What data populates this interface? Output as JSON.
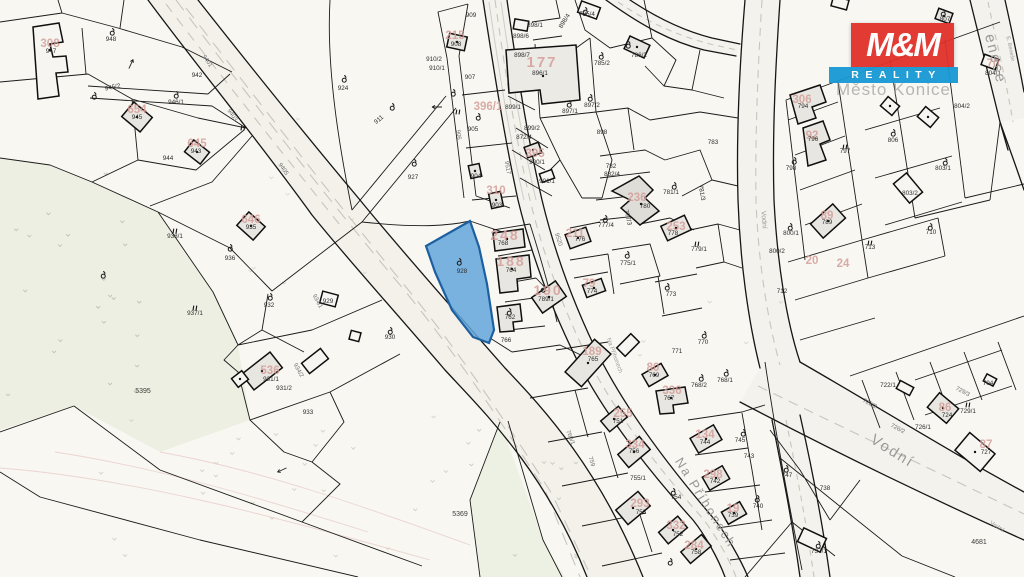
{
  "logo": {
    "mm": "M&M",
    "reality": "REALITY",
    "red": "#e0312a",
    "blue": "#1799d4"
  },
  "watermark": "Město Konice",
  "highlight": {
    "parcel_number": "928",
    "fill": "#63a6da",
    "stroke": "#1d5f9f"
  },
  "streets": [
    "Na Příhonech",
    "Vodní",
    "E. Beneše"
  ],
  "labels": {
    "parcels": [
      {
        "t": "948",
        "x": 111,
        "y": 41
      },
      {
        "t": "947",
        "x": 51,
        "y": 53
      },
      {
        "t": "946/2",
        "x": 113,
        "y": 89,
        "r": -12
      },
      {
        "t": "945",
        "x": 137,
        "y": 119
      },
      {
        "t": "946/1",
        "x": 176,
        "y": 104
      },
      {
        "t": "942",
        "x": 197,
        "y": 77
      },
      {
        "t": "944",
        "x": 168,
        "y": 160
      },
      {
        "t": "943",
        "x": 196,
        "y": 153
      },
      {
        "t": "924",
        "x": 343,
        "y": 90
      },
      {
        "t": "911",
        "x": 380,
        "y": 121,
        "r": -40
      },
      {
        "t": "927",
        "x": 413,
        "y": 179
      },
      {
        "t": "910/2",
        "x": 434,
        "y": 61
      },
      {
        "t": "910/1",
        "x": 437,
        "y": 70
      },
      {
        "t": "909",
        "x": 471,
        "y": 17
      },
      {
        "t": "908",
        "x": 456,
        "y": 46
      },
      {
        "t": "907",
        "x": 470,
        "y": 79
      },
      {
        "t": "905",
        "x": 473,
        "y": 131
      },
      {
        "t": "904",
        "x": 476,
        "y": 178
      },
      {
        "t": "903",
        "x": 497,
        "y": 207
      },
      {
        "t": "936",
        "x": 230,
        "y": 260
      },
      {
        "t": "935",
        "x": 251,
        "y": 229
      },
      {
        "t": "938/1",
        "x": 175,
        "y": 238
      },
      {
        "t": "937/1",
        "x": 195,
        "y": 315
      },
      {
        "t": "932",
        "x": 269,
        "y": 307
      },
      {
        "t": "929",
        "x": 328,
        "y": 303
      },
      {
        "t": "930",
        "x": 390,
        "y": 339
      },
      {
        "t": "931/1",
        "x": 271,
        "y": 381
      },
      {
        "t": "931/2",
        "x": 284,
        "y": 390
      },
      {
        "t": "933",
        "x": 308,
        "y": 414
      },
      {
        "t": "928",
        "x": 462,
        "y": 273
      },
      {
        "t": "898/1",
        "x": 535,
        "y": 27
      },
      {
        "t": "898/6",
        "x": 521,
        "y": 38
      },
      {
        "t": "898/7",
        "x": 522,
        "y": 57
      },
      {
        "t": "898/4",
        "x": 566,
        "y": 22,
        "r": -58
      },
      {
        "t": "896/1",
        "x": 540,
        "y": 75
      },
      {
        "t": "899/1",
        "x": 513,
        "y": 109
      },
      {
        "t": "899/2",
        "x": 532,
        "y": 130
      },
      {
        "t": "872/4",
        "x": 524,
        "y": 139
      },
      {
        "t": "900/1",
        "x": 537,
        "y": 164
      },
      {
        "t": "901/1",
        "x": 547,
        "y": 183
      },
      {
        "t": "785/4",
        "x": 587,
        "y": 16
      },
      {
        "t": "786/2",
        "x": 639,
        "y": 57
      },
      {
        "t": "785/2",
        "x": 602,
        "y": 65
      },
      {
        "t": "897/2",
        "x": 592,
        "y": 107
      },
      {
        "t": "897/1",
        "x": 570,
        "y": 113
      },
      {
        "t": "898",
        "x": 602,
        "y": 134
      },
      {
        "t": "783",
        "x": 713,
        "y": 144
      },
      {
        "t": "782",
        "x": 611,
        "y": 168
      },
      {
        "t": "882/4",
        "x": 612,
        "y": 176
      },
      {
        "t": "780",
        "x": 645,
        "y": 208
      },
      {
        "t": "781/1",
        "x": 671,
        "y": 194
      },
      {
        "t": "781/3",
        "x": 700,
        "y": 193,
        "r": 80
      },
      {
        "t": "777/4",
        "x": 606,
        "y": 227
      },
      {
        "t": "777/3",
        "x": 626,
        "y": 218,
        "r": 75
      },
      {
        "t": "778",
        "x": 673,
        "y": 235
      },
      {
        "t": "779/1",
        "x": 699,
        "y": 251
      },
      {
        "t": "776",
        "x": 580,
        "y": 241
      },
      {
        "t": "774",
        "x": 592,
        "y": 293
      },
      {
        "t": "775/1",
        "x": 628,
        "y": 265
      },
      {
        "t": "773",
        "x": 671,
        "y": 296
      },
      {
        "t": "768",
        "x": 503,
        "y": 245
      },
      {
        "t": "764",
        "x": 511,
        "y": 272
      },
      {
        "t": "789/1",
        "x": 546,
        "y": 301
      },
      {
        "t": "762",
        "x": 510,
        "y": 319
      },
      {
        "t": "766",
        "x": 506,
        "y": 342
      },
      {
        "t": "770",
        "x": 703,
        "y": 344
      },
      {
        "t": "771",
        "x": 677,
        "y": 353
      },
      {
        "t": "768/1",
        "x": 725,
        "y": 382
      },
      {
        "t": "768/2",
        "x": 699,
        "y": 387
      },
      {
        "t": "767",
        "x": 669,
        "y": 400
      },
      {
        "t": "769",
        "x": 654,
        "y": 377
      },
      {
        "t": "765",
        "x": 593,
        "y": 361
      },
      {
        "t": "751",
        "x": 618,
        "y": 423
      },
      {
        "t": "756",
        "x": 634,
        "y": 453
      },
      {
        "t": "755/1",
        "x": 638,
        "y": 480
      },
      {
        "t": "753",
        "x": 641,
        "y": 514
      },
      {
        "t": "754",
        "x": 676,
        "y": 499
      },
      {
        "t": "744",
        "x": 705,
        "y": 444
      },
      {
        "t": "745",
        "x": 740,
        "y": 442
      },
      {
        "t": "743",
        "x": 749,
        "y": 458
      },
      {
        "t": "742",
        "x": 715,
        "y": 483
      },
      {
        "t": "740",
        "x": 758,
        "y": 508
      },
      {
        "t": "739",
        "x": 733,
        "y": 517
      },
      {
        "t": "752",
        "x": 678,
        "y": 536
      },
      {
        "t": "758",
        "x": 696,
        "y": 554
      },
      {
        "t": "794",
        "x": 803,
        "y": 108
      },
      {
        "t": "796",
        "x": 813,
        "y": 141
      },
      {
        "t": "797",
        "x": 845,
        "y": 153
      },
      {
        "t": "798",
        "x": 791,
        "y": 170
      },
      {
        "t": "806",
        "x": 893,
        "y": 142
      },
      {
        "t": "803/1",
        "x": 943,
        "y": 170
      },
      {
        "t": "803/2",
        "x": 910,
        "y": 195
      },
      {
        "t": "800/1",
        "x": 791,
        "y": 235
      },
      {
        "t": "800/2",
        "x": 777,
        "y": 253
      },
      {
        "t": "789",
        "x": 827,
        "y": 224
      },
      {
        "t": "710",
        "x": 931,
        "y": 234
      },
      {
        "t": "713",
        "x": 870,
        "y": 249
      },
      {
        "t": "712",
        "x": 782,
        "y": 293
      },
      {
        "t": "807",
        "x": 945,
        "y": 21
      },
      {
        "t": "804/1",
        "x": 993,
        "y": 75
      },
      {
        "t": "804/2",
        "x": 962,
        "y": 108
      },
      {
        "t": "704",
        "x": 988,
        "y": 385
      },
      {
        "t": "722/1",
        "x": 888,
        "y": 387
      },
      {
        "t": "726/1",
        "x": 923,
        "y": 429
      },
      {
        "t": "724",
        "x": 947,
        "y": 417
      },
      {
        "t": "729/1",
        "x": 968,
        "y": 413
      },
      {
        "t": "727",
        "x": 986,
        "y": 454
      },
      {
        "t": "747",
        "x": 787,
        "y": 477
      },
      {
        "t": "738",
        "x": 825,
        "y": 490
      },
      {
        "t": "737/1",
        "x": 819,
        "y": 553
      }
    ],
    "field_parcels": [
      {
        "t": "5395",
        "x": 143,
        "y": 393
      },
      {
        "t": "5369",
        "x": 460,
        "y": 516
      },
      {
        "t": "4681",
        "x": 979,
        "y": 544
      }
    ],
    "road_parcels": [
      {
        "t": "9401",
        "x": 206,
        "y": 62,
        "r": 55
      },
      {
        "t": "9403",
        "x": 231,
        "y": 116,
        "r": 55
      },
      {
        "t": "9405",
        "x": 282,
        "y": 170,
        "r": 55
      },
      {
        "t": "9517",
        "x": 506,
        "y": 168,
        "r": 80
      },
      {
        "t": "9520",
        "x": 557,
        "y": 240,
        "r": 72
      },
      {
        "t": "934/1",
        "x": 316,
        "y": 302,
        "r": 62
      },
      {
        "t": "934/2",
        "x": 297,
        "y": 371,
        "r": 62
      },
      {
        "t": "906",
        "x": 457,
        "y": 135,
        "r": 82
      },
      {
        "t": "760/1",
        "x": 569,
        "y": 438,
        "r": 68
      },
      {
        "t": "759",
        "x": 590,
        "y": 462,
        "r": 72
      },
      {
        "t": "722/2",
        "x": 869,
        "y": 405,
        "r": 28
      },
      {
        "t": "726/2",
        "x": 897,
        "y": 430,
        "r": 28
      },
      {
        "t": "729/3",
        "x": 962,
        "y": 393,
        "r": 28
      }
    ],
    "house_numbers": [
      {
        "t": "308",
        "x": 50,
        "y": 47
      },
      {
        "t": "215",
        "x": 455,
        "y": 39
      },
      {
        "t": "654",
        "x": 137,
        "y": 113
      },
      {
        "t": "645",
        "x": 197,
        "y": 147
      },
      {
        "t": "646",
        "x": 251,
        "y": 223
      },
      {
        "t": "536",
        "x": 270,
        "y": 374
      },
      {
        "t": "177",
        "x": 542,
        "y": 67,
        "fs": 15
      },
      {
        "t": "396/1",
        "x": 488,
        "y": 110
      },
      {
        "t": "395",
        "x": 535,
        "y": 157
      },
      {
        "t": "310",
        "x": 496,
        "y": 194
      },
      {
        "t": "248",
        "x": 505,
        "y": 240,
        "fs": 14
      },
      {
        "t": "188",
        "x": 511,
        "y": 266,
        "fs": 14
      },
      {
        "t": "190",
        "x": 548,
        "y": 295,
        "fs": 14
      },
      {
        "t": "211",
        "x": 575,
        "y": 237
      },
      {
        "t": "236",
        "x": 637,
        "y": 201
      },
      {
        "t": "253",
        "x": 676,
        "y": 230
      },
      {
        "t": "79",
        "x": 589,
        "y": 287
      },
      {
        "t": "189",
        "x": 592,
        "y": 355
      },
      {
        "t": "80",
        "x": 653,
        "y": 371
      },
      {
        "t": "336",
        "x": 672,
        "y": 394
      },
      {
        "t": "255",
        "x": 623,
        "y": 417
      },
      {
        "t": "334",
        "x": 635,
        "y": 448
      },
      {
        "t": "134",
        "x": 705,
        "y": 438
      },
      {
        "t": "298",
        "x": 713,
        "y": 478
      },
      {
        "t": "19",
        "x": 733,
        "y": 512
      },
      {
        "t": "293",
        "x": 640,
        "y": 507
      },
      {
        "t": "332",
        "x": 676,
        "y": 529
      },
      {
        "t": "284",
        "x": 694,
        "y": 549
      },
      {
        "t": "306",
        "x": 802,
        "y": 103
      },
      {
        "t": "92",
        "x": 812,
        "y": 139
      },
      {
        "t": "89",
        "x": 827,
        "y": 219
      },
      {
        "t": "86",
        "x": 945,
        "y": 411
      },
      {
        "t": "87",
        "x": 986,
        "y": 448
      },
      {
        "t": "70",
        "x": 993,
        "y": 67
      },
      {
        "t": "20",
        "x": 812,
        "y": 264
      },
      {
        "t": "24",
        "x": 843,
        "y": 267
      }
    ],
    "street_names": [
      {
        "t": "Na Příhonech",
        "x": 702,
        "y": 505,
        "r": 58,
        "fs": 13
      },
      {
        "t": "Na Příhonech",
        "x": 613,
        "y": 356,
        "r": 70,
        "fs": 6
      },
      {
        "t": "Vodní",
        "x": 890,
        "y": 455,
        "r": 32,
        "fs": 15
      },
      {
        "t": "Vodní",
        "x": 762,
        "y": 220,
        "r": 86,
        "fs": 7
      },
      {
        "t": "Vodní",
        "x": 996,
        "y": 528,
        "r": 32,
        "fs": 6
      },
      {
        "t": "enese",
        "x": 991,
        "y": 60,
        "r": 76,
        "fs": 15
      },
      {
        "t": "E. Beneše",
        "x": 1009,
        "y": 49,
        "r": 78,
        "fs": 5.5
      }
    ]
  },
  "symbols": {
    "land_use_icons": [
      [
        112,
        32
      ],
      [
        94,
        96
      ],
      [
        176,
        95
      ],
      [
        344,
        79
      ],
      [
        392,
        107
      ],
      [
        414,
        163
      ],
      [
        453,
        93
      ],
      [
        230,
        248
      ],
      [
        270,
        297
      ],
      [
        390,
        331
      ],
      [
        103,
        275
      ],
      [
        459,
        262
      ],
      [
        478,
        117
      ],
      [
        585,
        11
      ],
      [
        628,
        45
      ],
      [
        601,
        56
      ],
      [
        590,
        98
      ],
      [
        569,
        104
      ],
      [
        543,
        289
      ],
      [
        509,
        312
      ],
      [
        674,
        186
      ],
      [
        605,
        219
      ],
      [
        627,
        255
      ],
      [
        667,
        287
      ],
      [
        704,
        335
      ],
      [
        726,
        373
      ],
      [
        701,
        378
      ],
      [
        673,
        492
      ],
      [
        743,
        433
      ],
      [
        757,
        499
      ],
      [
        786,
        469
      ],
      [
        670,
        562
      ],
      [
        818,
        545
      ],
      [
        794,
        161
      ],
      [
        893,
        133
      ],
      [
        945,
        162
      ],
      [
        790,
        227
      ],
      [
        930,
        227
      ],
      [
        943,
        13
      ]
    ],
    "double_ticks": [
      [
        175,
        231
      ],
      [
        195,
        308
      ],
      [
        243,
        128
      ],
      [
        458,
        112
      ],
      [
        845,
        147
      ],
      [
        870,
        243
      ],
      [
        697,
        244
      ],
      [
        968,
        405
      ]
    ],
    "arrows": [
      [
        437,
        107,
        0
      ],
      [
        282,
        470,
        -25
      ],
      [
        131,
        64,
        115
      ]
    ]
  }
}
